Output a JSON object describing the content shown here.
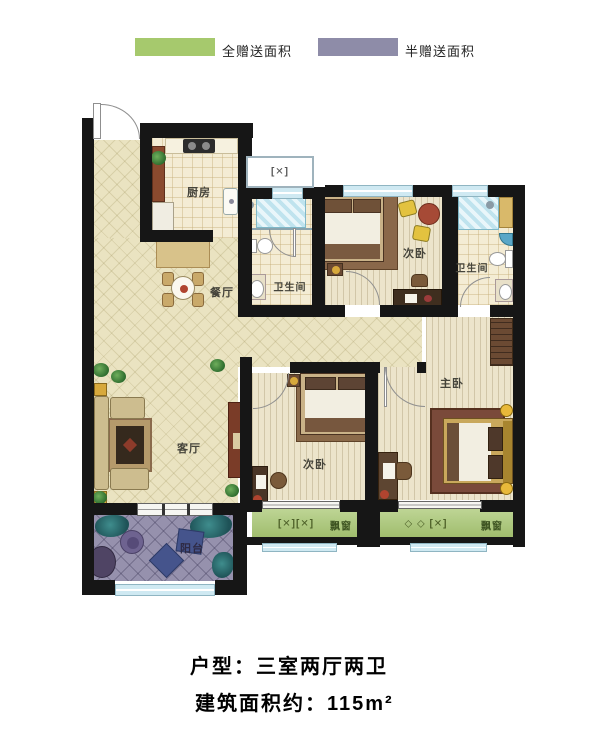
{
  "legend": {
    "items": [
      {
        "label": "全赠送面积",
        "color": "#a6c96d"
      },
      {
        "label": "半赠送面积",
        "color": "#8e8ca8"
      }
    ]
  },
  "rooms": {
    "kitchen": "厨房",
    "dining": "餐厅",
    "living": "客厅",
    "balcony": "阳台",
    "bedroom_top": "次卧",
    "bedroom_bottom": "次卧",
    "master_bedroom": "主卧",
    "bathroom_1": "卫生间",
    "bathroom_2": "卫生间"
  },
  "bay_windows": {
    "left_label": "飘窗",
    "right_label": "飘窗",
    "left_glyph": "[✕][✕]",
    "right_glyph": "◇ ◇ [✕]",
    "shaft_glyph": "[✕]"
  },
  "caption": {
    "line1": "户型：三室两厅两卫",
    "line2": "建筑面积约：115m²"
  },
  "colors": {
    "wall": "#161616",
    "full_gift_green": "#a6c96d",
    "half_gift_purple": "#8e8ca8",
    "main_floor": "#eae3c1",
    "bedroom_floor": "#ece4cb",
    "tile_floor": "#f4ecd4",
    "balcony_floor": "#9691ad",
    "window_glass": "#cfe9f2"
  }
}
